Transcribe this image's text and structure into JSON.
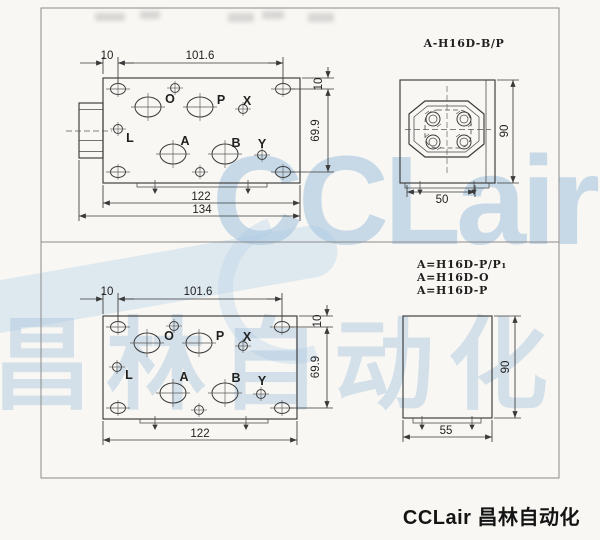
{
  "watermark": {
    "latin": "CCLair",
    "cjk": "昌林自动化"
  },
  "footer": {
    "brand": "CCLair 昌林自动化"
  },
  "top_section": {
    "model_label": "A-H16D-B/P",
    "front_view": {
      "ports": {
        "o": "O",
        "p": "P",
        "x": "X",
        "l": "L",
        "a": "A",
        "b": "B",
        "y": "Y"
      },
      "dims": {
        "offset": "10",
        "pitch": "101.6",
        "width": "122",
        "total_width": "134",
        "v_offset": "10",
        "v_pitch": "69.9"
      }
    },
    "side_view": {
      "depth": "50",
      "height": "90"
    }
  },
  "bottom_section": {
    "model_labels": {
      "l1": "A=H16D-P/P₁",
      "l2": "A=H16D-O",
      "l3": "A=H16D-P"
    },
    "front_view": {
      "ports": {
        "o": "O",
        "p": "P",
        "x": "X",
        "l": "L",
        "a": "A",
        "b": "B",
        "y": "Y"
      },
      "dims": {
        "offset": "10",
        "pitch": "101.6",
        "width": "122",
        "v_offset": "10",
        "v_pitch": "69.9"
      }
    },
    "side_view": {
      "depth": "55",
      "height": "90"
    }
  }
}
